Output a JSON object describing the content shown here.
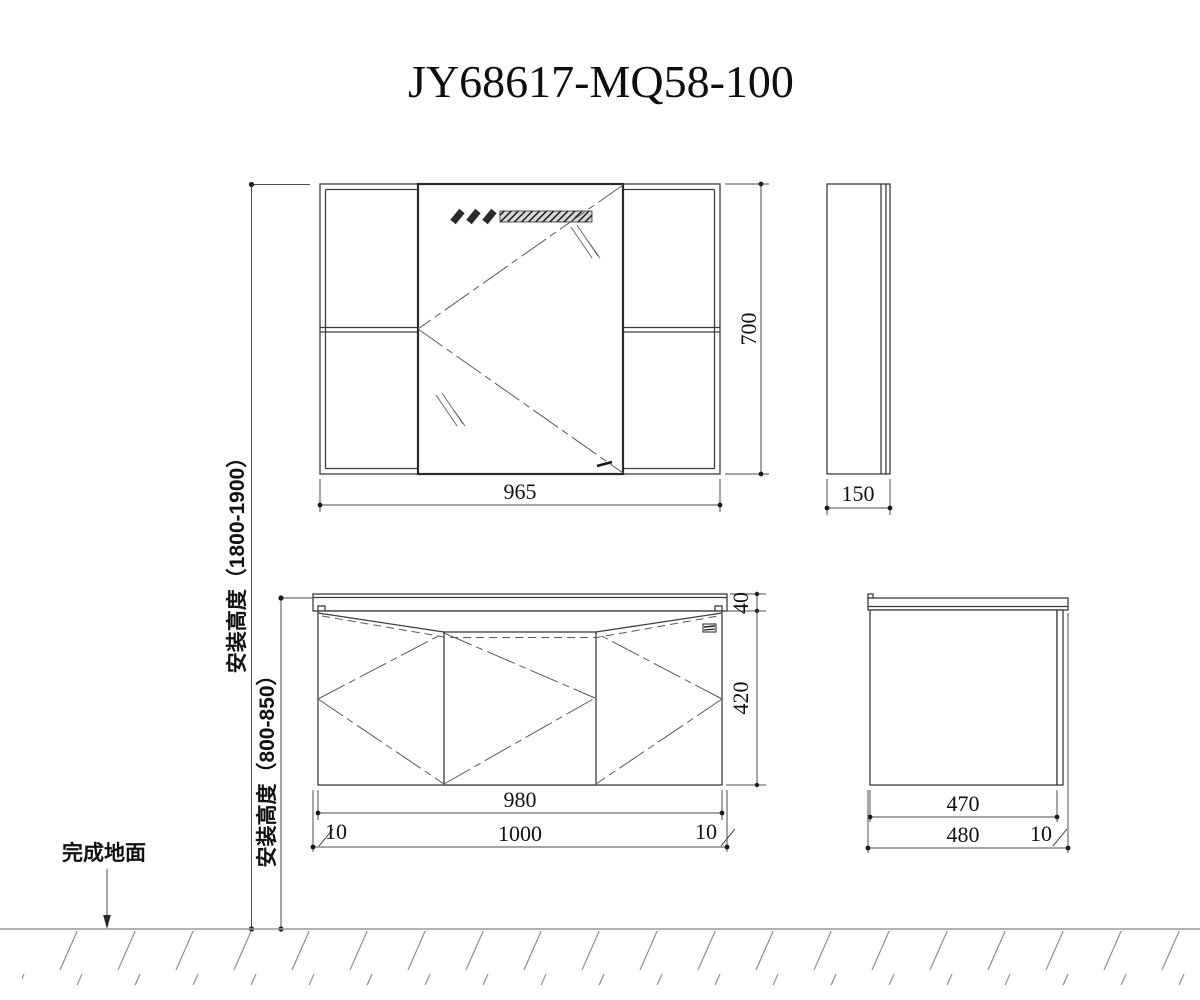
{
  "title": "JY68617-MQ58-100",
  "colors": {
    "background": "#ffffff",
    "line": "#3d3d3d",
    "dimension_line": "#4d4d4d",
    "text": "#111111",
    "floor_hatch": "#8f8f8f"
  },
  "views": {
    "mirror_front": {
      "width": "965",
      "height": "700"
    },
    "mirror_side": {
      "depth": "150"
    },
    "vanity_front": {
      "counter_height": "40",
      "body_height": "420",
      "body_width": "980",
      "total_width": "1000",
      "left_overhang": "10",
      "right_overhang": "10"
    },
    "vanity_side": {
      "body_depth": "470",
      "total_depth": "480",
      "overhang": "10"
    }
  },
  "annotations": {
    "mirror_install_height": "安装高度（1800-1900）",
    "vanity_install_height": "安装高度（800-850）",
    "floor_label": "完成地面"
  }
}
